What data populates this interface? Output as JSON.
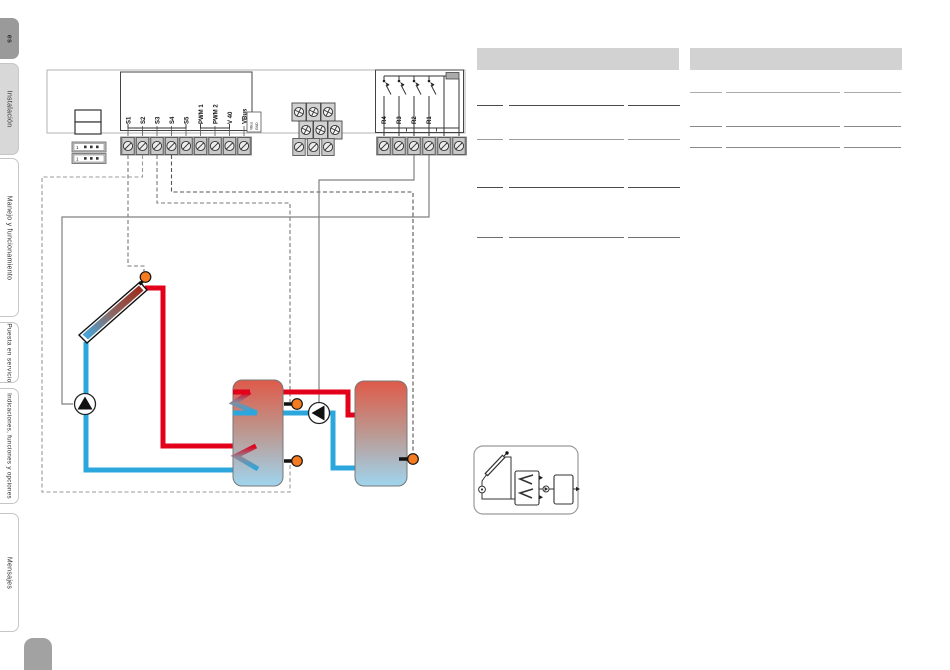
{
  "sidebar": {
    "language_tab": "es",
    "tabs": [
      {
        "label": "Instalación",
        "active": true
      },
      {
        "label": "Manejo y funcionamiento",
        "active": false
      },
      {
        "label": "Puesta en servicio",
        "active": false
      },
      {
        "label": "Indicaciones, funciones y opciones",
        "active": false
      },
      {
        "label": "Mensajes",
        "active": false
      }
    ]
  },
  "terminals": {
    "sensors": [
      "S1",
      "S2",
      "S3",
      "S4",
      "S5",
      "PWM 1",
      "PWM 2",
      "V 40",
      "VBus"
    ],
    "vbus_label": [
      "VBus",
      "GND"
    ],
    "relays": [
      "R4",
      "R3",
      "R2",
      "R1"
    ],
    "connector_pin": "1"
  },
  "colors": {
    "sensor_dot": "#f47b20",
    "pipe_hot": "#e2001a",
    "pipe_cold": "#2ba7de",
    "table_header": "#d2d2d2",
    "tab_active": "#d8d8d8",
    "tab_language": "#9a9a9a"
  }
}
